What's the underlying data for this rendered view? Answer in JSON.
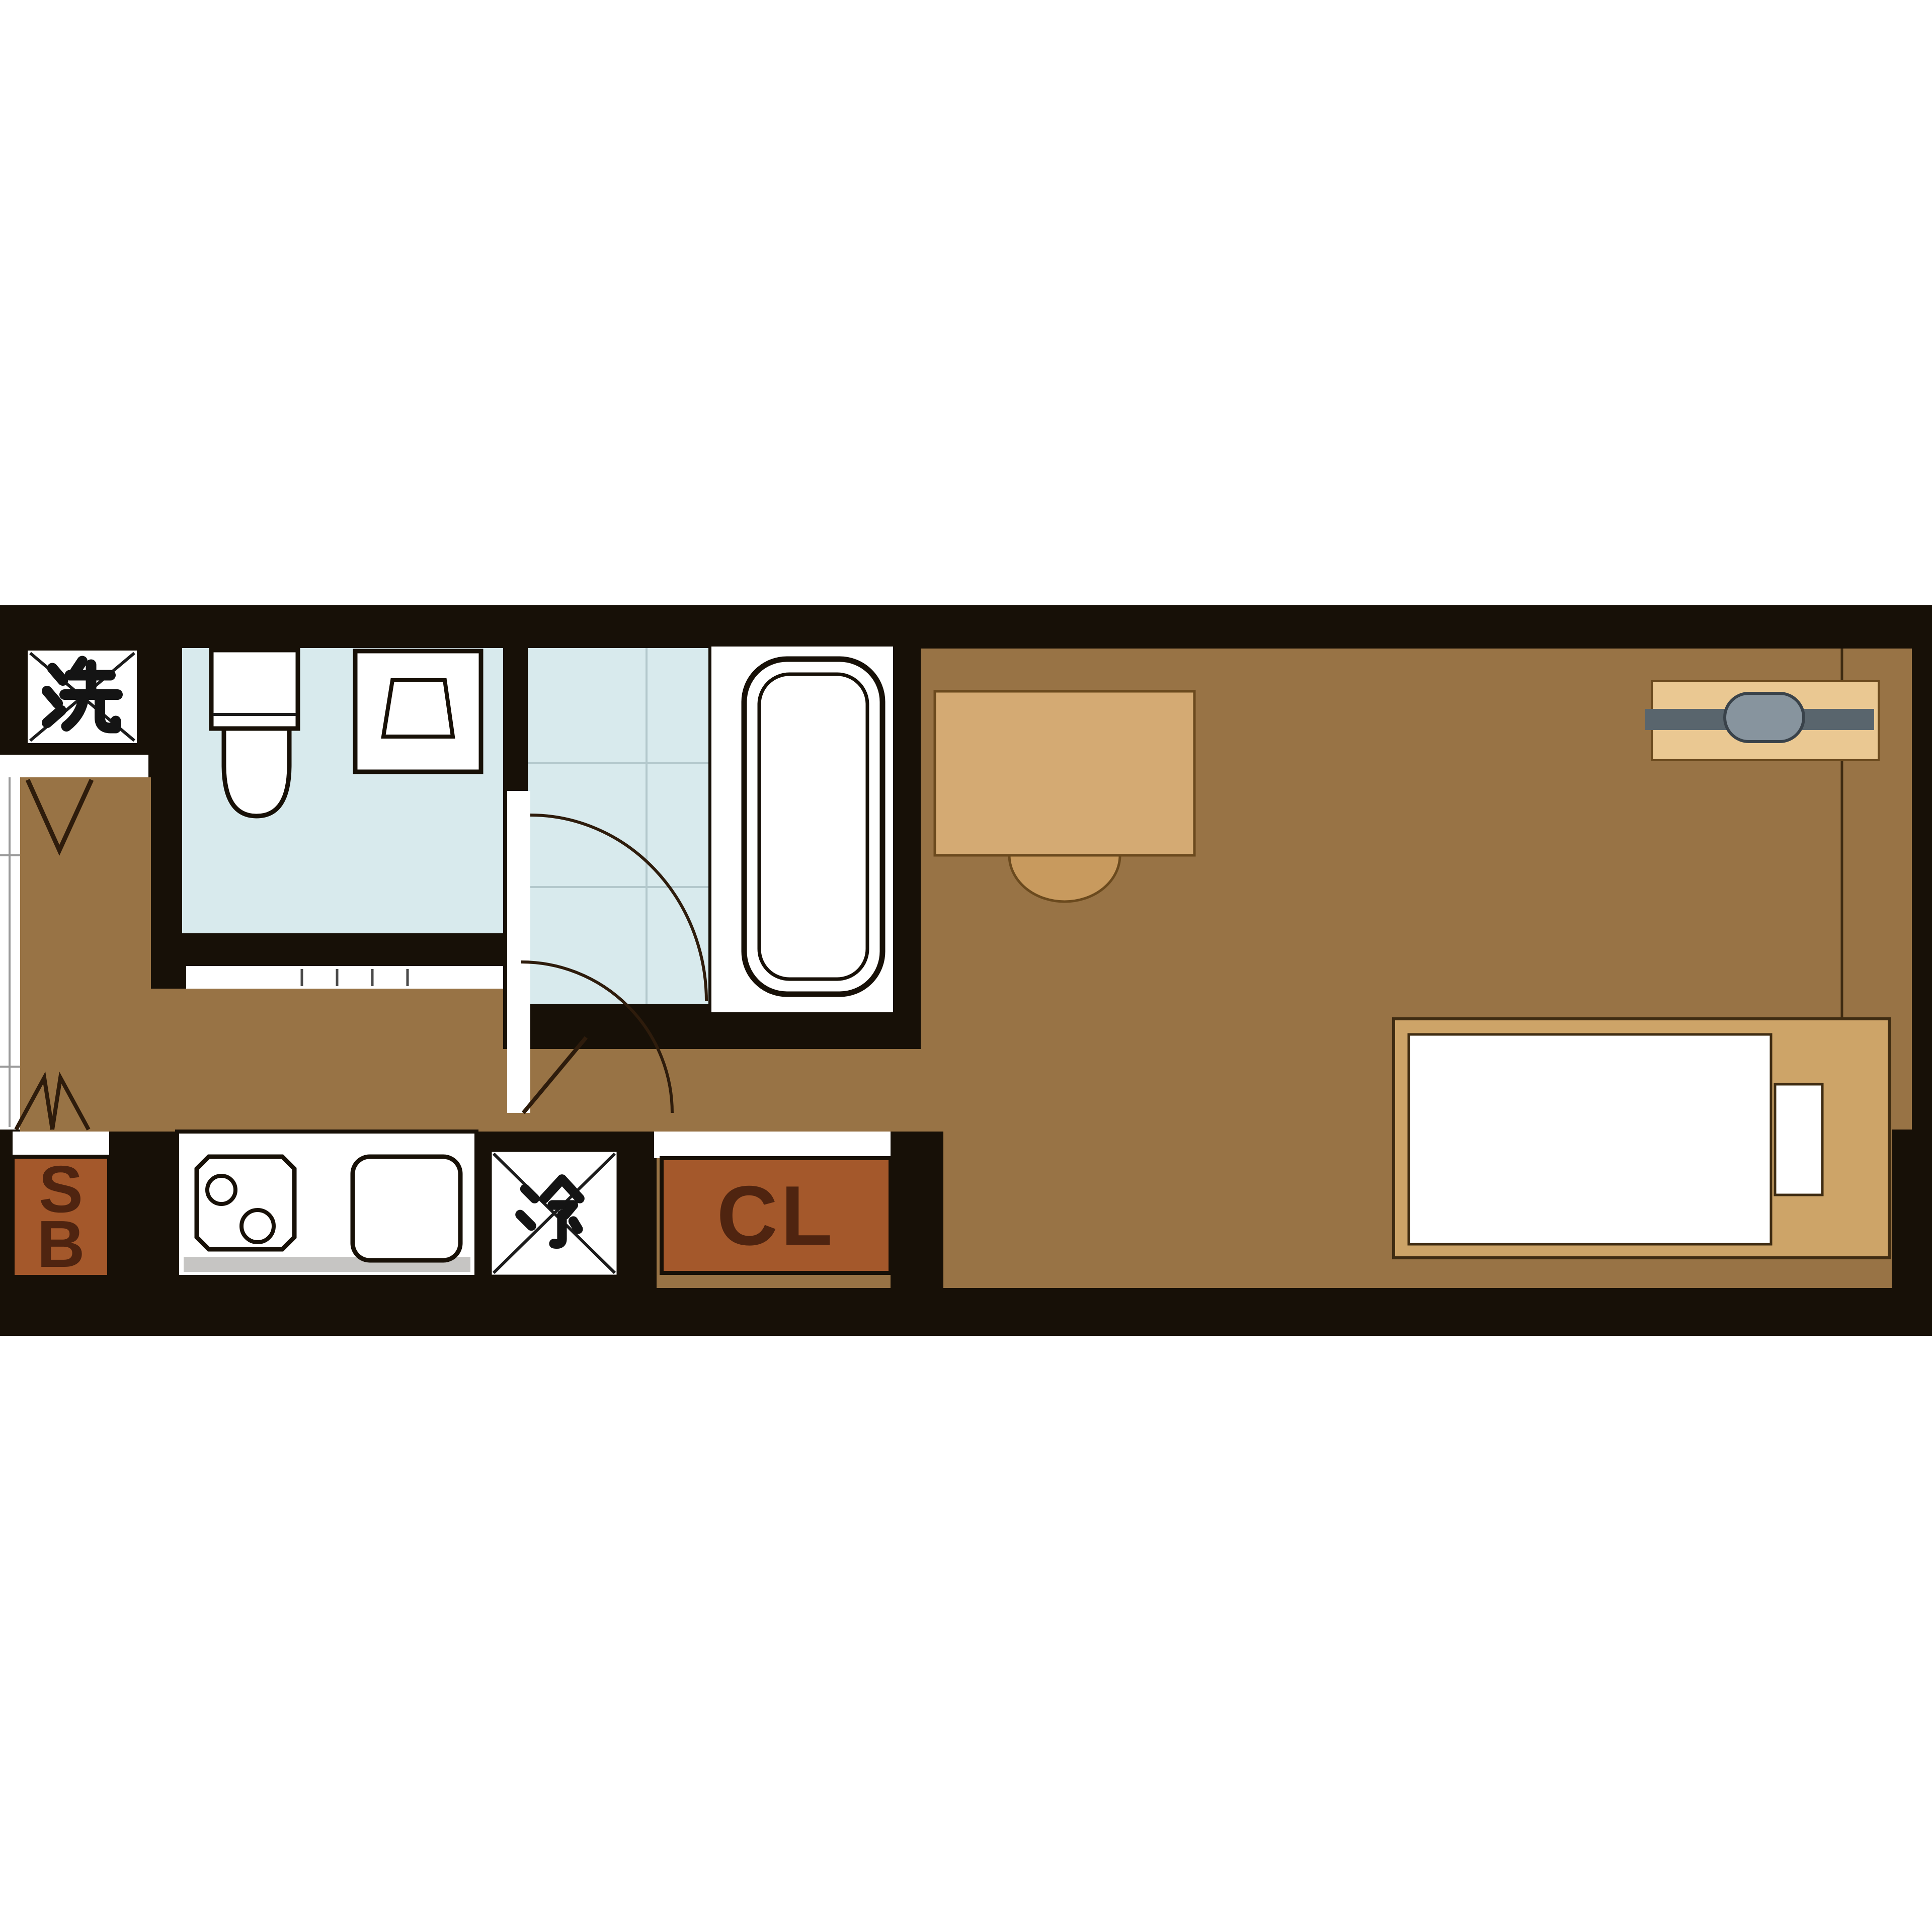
{
  "plan_type": "apartment-floor-plan",
  "labels": {
    "washing_machine": "洗",
    "refrigerator": "冷",
    "shoe_box": "SB",
    "closet": "CL"
  },
  "fixtures": [
    "washing-machine-alcove",
    "entrance-opening",
    "entrance-door-swing-mark",
    "toilet",
    "bathroom-sink",
    "shower-room",
    "shower-door-swing",
    "bathtub",
    "room-door-swing",
    "shoe-box",
    "kitchen-counter",
    "kitchen-stove",
    "kitchen-sink",
    "refrigerator",
    "closet",
    "bifold-door-mark",
    "desk",
    "chair",
    "air-conditioner",
    "bed",
    "mattress",
    "pillow"
  ],
  "colors": {
    "wall": "#171007",
    "floor": "#987345",
    "wetroom": "#d8eaed",
    "wetgrid": "#b3c8cc",
    "white": "#ffffff",
    "cabinet": "#a4582b",
    "cabinet_text": "#4f2410",
    "desk": "#d4aa73",
    "chair": "#c89a5e",
    "furniture_outline": "#6b4a1e",
    "bed_frame": "#cda468",
    "bed_outline": "#3f2c12",
    "ac_body": "#eac892",
    "ac_bar": "#59656d",
    "ac_oval": "#87949e",
    "ac_outline": "#39424a",
    "arc": "#2e1c0c",
    "counter_edge": "#c6c5c3",
    "fixture_outline": "#171007",
    "sill_line": "#9a9a9a"
  }
}
